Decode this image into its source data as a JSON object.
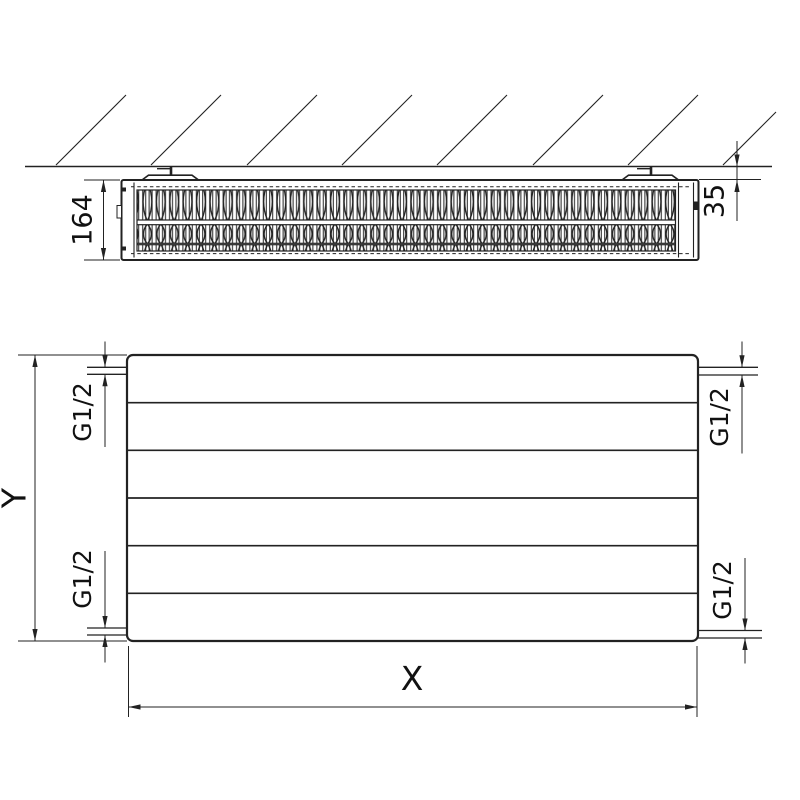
{
  "colors": {
    "ink": "#222222",
    "text": "#111111",
    "background": "#ffffff"
  },
  "top_view": {
    "depth_dimension": "164",
    "wall_clearance_dimension": "35"
  },
  "front_view": {
    "height_dimension": "Y",
    "width_dimension": "X",
    "connections": {
      "top_left": "G1/2",
      "bottom_left": "G1/2",
      "top_right": "G1/2",
      "bottom_right": "G1/2"
    }
  }
}
